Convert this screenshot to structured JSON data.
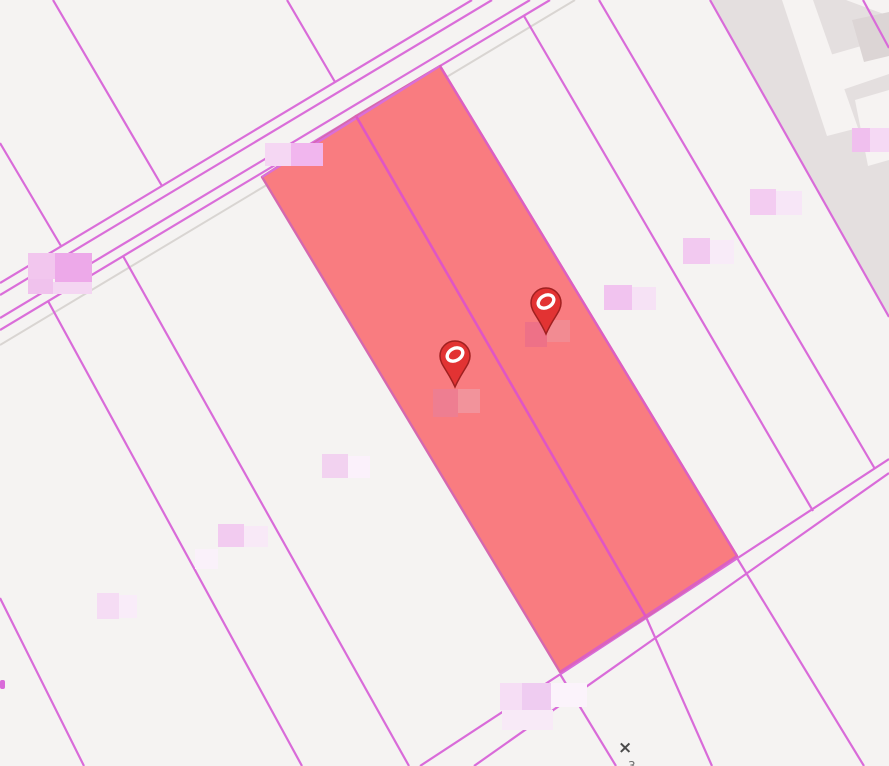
{
  "app": {
    "type": "cadastral-map-viewport",
    "description": "real-estate parcel map with two highlighted lots and two listing pins"
  },
  "canvas": {
    "width": 889,
    "height": 766,
    "background": "#f5f3f2"
  },
  "colors": {
    "parcel_line": "#d96bd9",
    "road_line": "#da6ed9",
    "shadow_line": "#d9d5d2",
    "highlight_fill": "#f97c80",
    "highlight_stroke": "#d668ae",
    "highlight_divider": "#e155c5",
    "highlight_bright_edge": "#dd5fc2",
    "built_up_area": "#e4dfdf",
    "building_light": "#f6f3f2",
    "building_dark": "#dcd5d5",
    "marker_red": "#e23333",
    "marker_rim": "#a02020",
    "marker_glyph": "#ffffff",
    "annotation_color": "#4b4b4b"
  },
  "map": {
    "areas": [
      {
        "name": "built-up-area",
        "points": "710,0 889,0 889,317",
        "color": "#e4dfdf"
      },
      {
        "name": "building-footprint",
        "points": "782,0 813,0 858,128 827,136",
        "color": "#f6f3f2"
      },
      {
        "name": "building-footprint",
        "points": "846,0 889,0 889,16",
        "color": "#f6f3f2"
      },
      {
        "name": "building-footprint",
        "points": "830,55 889,38 889,74 842,90",
        "color": "#f6f3f2"
      },
      {
        "name": "building-footprint",
        "points": "855,100 889,90 889,160 868,166",
        "color": "#f6f3f2"
      },
      {
        "name": "building-courtyard",
        "points": "852,20 889,12 889,56 864,62",
        "color": "#dcd5d5"
      }
    ],
    "shadow_lines": [
      [
        0,
        345,
        575,
        0
      ]
    ],
    "road_lines": [
      [
        0,
        283,
        472,
        0
      ],
      [
        0,
        295,
        492,
        0
      ],
      [
        0,
        318,
        530,
        0
      ],
      [
        0,
        330,
        550,
        0
      ]
    ],
    "parcel_lines": [
      [
        53,
        0,
        162,
        186
      ],
      [
        287,
        0,
        335,
        82
      ],
      [
        0,
        143,
        61,
        246
      ],
      [
        0,
        598,
        84,
        766
      ],
      [
        48,
        301,
        302,
        766
      ],
      [
        123,
        256,
        409,
        766
      ],
      [
        524,
        16,
        813,
        511
      ],
      [
        599,
        0,
        875,
        469
      ],
      [
        710,
        0,
        889,
        317
      ],
      [
        863,
        0,
        889,
        48
      ],
      [
        420,
        766,
        889,
        459
      ],
      [
        474,
        766,
        889,
        473
      ],
      [
        560,
        674,
        616,
        766
      ],
      [
        646,
        617,
        712,
        766
      ],
      [
        737,
        558,
        864,
        766
      ]
    ],
    "edge_stub": {
      "x": 0,
      "y": 680,
      "w": 5,
      "h": 9
    },
    "highlight": {
      "parcels": [
        {
          "name": "highlighted-parcel-west",
          "points": "262,177 356,116 646,617 560,672"
        },
        {
          "name": "highlighted-parcel-east",
          "points": "356,116 440,66 737,556 646,617"
        }
      ],
      "divider": [
        356,
        116,
        646,
        617
      ],
      "top_edge": [
        262,
        177,
        440,
        66
      ],
      "right_edge": [
        440,
        66,
        737,
        556
      ],
      "bottom_edge": [
        560,
        672,
        737,
        556
      ]
    },
    "redacted_labels": [
      {
        "x": 265,
        "y": 143,
        "cells": [
          [
            0,
            0,
            26,
            23,
            "#f5d7f3"
          ],
          [
            26,
            0,
            32,
            23,
            "#f1b6ee"
          ]
        ]
      },
      {
        "x": 28,
        "y": 253,
        "cells": [
          [
            0,
            0,
            27,
            26,
            "#f2c6ee"
          ],
          [
            27,
            0,
            37,
            30,
            "#eda9e9"
          ],
          [
            0,
            26,
            25,
            15,
            "#f0c2ed"
          ],
          [
            25,
            29,
            39,
            12,
            "#f4d6f2"
          ]
        ]
      },
      {
        "x": 852,
        "y": 128,
        "cells": [
          [
            0,
            0,
            18,
            24,
            "#f0bfee"
          ],
          [
            18,
            0,
            19,
            24,
            "#f5d9f4"
          ]
        ]
      },
      {
        "x": 750,
        "y": 189,
        "cells": [
          [
            0,
            0,
            26,
            26,
            "#f3ccf1"
          ],
          [
            26,
            2,
            26,
            24,
            "#f7e6f7"
          ]
        ]
      },
      {
        "x": 683,
        "y": 238,
        "cells": [
          [
            0,
            0,
            27,
            26,
            "#f2c9f0"
          ],
          [
            27,
            2,
            24,
            24,
            "#f8ebf8"
          ]
        ]
      },
      {
        "x": 604,
        "y": 285,
        "cells": [
          [
            0,
            0,
            28,
            25,
            "#f1c3ef"
          ],
          [
            28,
            2,
            24,
            23,
            "#f6e2f5"
          ]
        ]
      },
      {
        "x": 525,
        "y": 320,
        "cells": [
          [
            0,
            2,
            22,
            25,
            "#ee7187"
          ],
          [
            22,
            0,
            23,
            22,
            "#f28b92"
          ]
        ]
      },
      {
        "x": 433,
        "y": 389,
        "cells": [
          [
            0,
            0,
            25,
            28,
            "#ee7e91"
          ],
          [
            25,
            0,
            22,
            24,
            "#f2939b"
          ]
        ]
      },
      {
        "x": 322,
        "y": 454,
        "cells": [
          [
            0,
            0,
            26,
            24,
            "#f2d2f0"
          ],
          [
            26,
            2,
            22,
            22,
            "#fbf1fb"
          ]
        ]
      },
      {
        "x": 218,
        "y": 524,
        "cells": [
          [
            0,
            0,
            26,
            23,
            "#f2cbf0"
          ],
          [
            26,
            2,
            24,
            21,
            "#f8e9f7"
          ]
        ]
      },
      {
        "x": 195,
        "y": 549,
        "cells": [
          [
            0,
            0,
            23,
            20,
            "#faf1fa"
          ]
        ]
      },
      {
        "x": 97,
        "y": 593,
        "cells": [
          [
            0,
            0,
            22,
            26,
            "#f5dcf4"
          ],
          [
            22,
            2,
            18,
            23,
            "#f9ecf9"
          ]
        ]
      },
      {
        "x": 500,
        "y": 683,
        "cells": [
          [
            0,
            0,
            22,
            27,
            "#f6def5"
          ],
          [
            22,
            0,
            29,
            27,
            "#efccf1"
          ],
          [
            51,
            0,
            36,
            24,
            "#fbf3fb"
          ],
          [
            2,
            27,
            51,
            20,
            "#f8eaf7"
          ]
        ]
      }
    ],
    "markers": [
      {
        "name": "map-pin-1",
        "x": 455,
        "y": 356
      },
      {
        "name": "map-pin-2",
        "x": 546,
        "y": 303
      }
    ],
    "annotations": [
      {
        "name": "survey-cross-marker",
        "text": "×",
        "x": 618,
        "y": 753,
        "size": 17,
        "color": "#4b4b4b",
        "bold": true
      },
      {
        "name": "survey-number",
        "text": "3",
        "x": 628,
        "y": 770,
        "size": 12,
        "color": "#6e6e6e",
        "bold": false
      }
    ]
  }
}
